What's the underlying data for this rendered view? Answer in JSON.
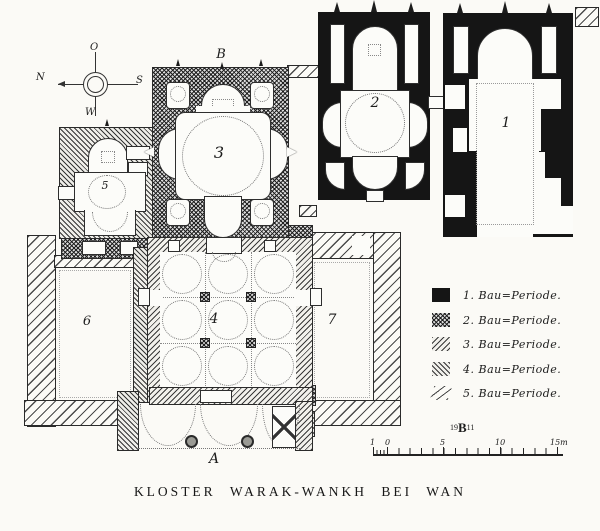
{
  "title": "KLOSTER WARAK-WANKH BEI WAN",
  "compass": {
    "east": "O",
    "south": "S",
    "west": "W",
    "north": "N"
  },
  "plan_labels": {
    "b1": "1",
    "b2": "2",
    "b3": "3",
    "b4": "4",
    "b5": "5",
    "b6": "6",
    "b7": "7",
    "section_a": "A",
    "section_b": "B"
  },
  "legend": {
    "items": [
      {
        "label": "1. Bau=Periode.",
        "pattern": "solid-black"
      },
      {
        "label": "2. Bau=Periode.",
        "pattern": "cross-hatch-dense"
      },
      {
        "label": "3. Bau=Periode.",
        "pattern": "diagonal-hatch"
      },
      {
        "label": "4. Bau=Periode.",
        "pattern": "diagonal-hatch-dense"
      },
      {
        "label": "5. Bau=Periode.",
        "pattern": "diagonal-lines-sparse"
      }
    ]
  },
  "monogram": {
    "prefix": "19",
    "initial": "B",
    "suffix": "11"
  },
  "scalebar": {
    "labels": [
      "1",
      "0",
      "5",
      "10",
      "15m"
    ]
  },
  "colors": {
    "ink": "#1c1c1c",
    "paper": "#fbfaf6"
  }
}
